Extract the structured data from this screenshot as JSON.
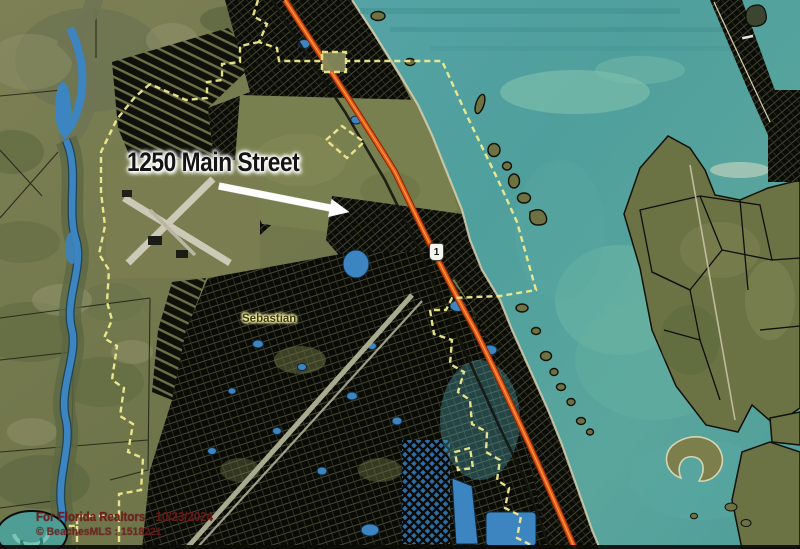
{
  "map": {
    "annotation": {
      "label": "1250 Main Street"
    },
    "city_label": "Sebastian",
    "route_shield": "1",
    "watermark": {
      "line1": "For Florida Realtors - 10/23/2024",
      "line2": "© BeachesMLS : 1518221"
    },
    "colors": {
      "water": "#4f9f9d",
      "land": "#75794e",
      "parcel_fill": "#0a0a07",
      "highway_orange": "#ee5a1e",
      "city_boundary_yellow": "#f0ea8e",
      "water_feature_blue": "#3c85c0",
      "annotation_text": "#151515",
      "annotation_halo": "#ffffff",
      "city_label_text": "#3f3f10",
      "city_label_halo": "#f8f4b0",
      "watermark_text": "#741c1a"
    }
  }
}
